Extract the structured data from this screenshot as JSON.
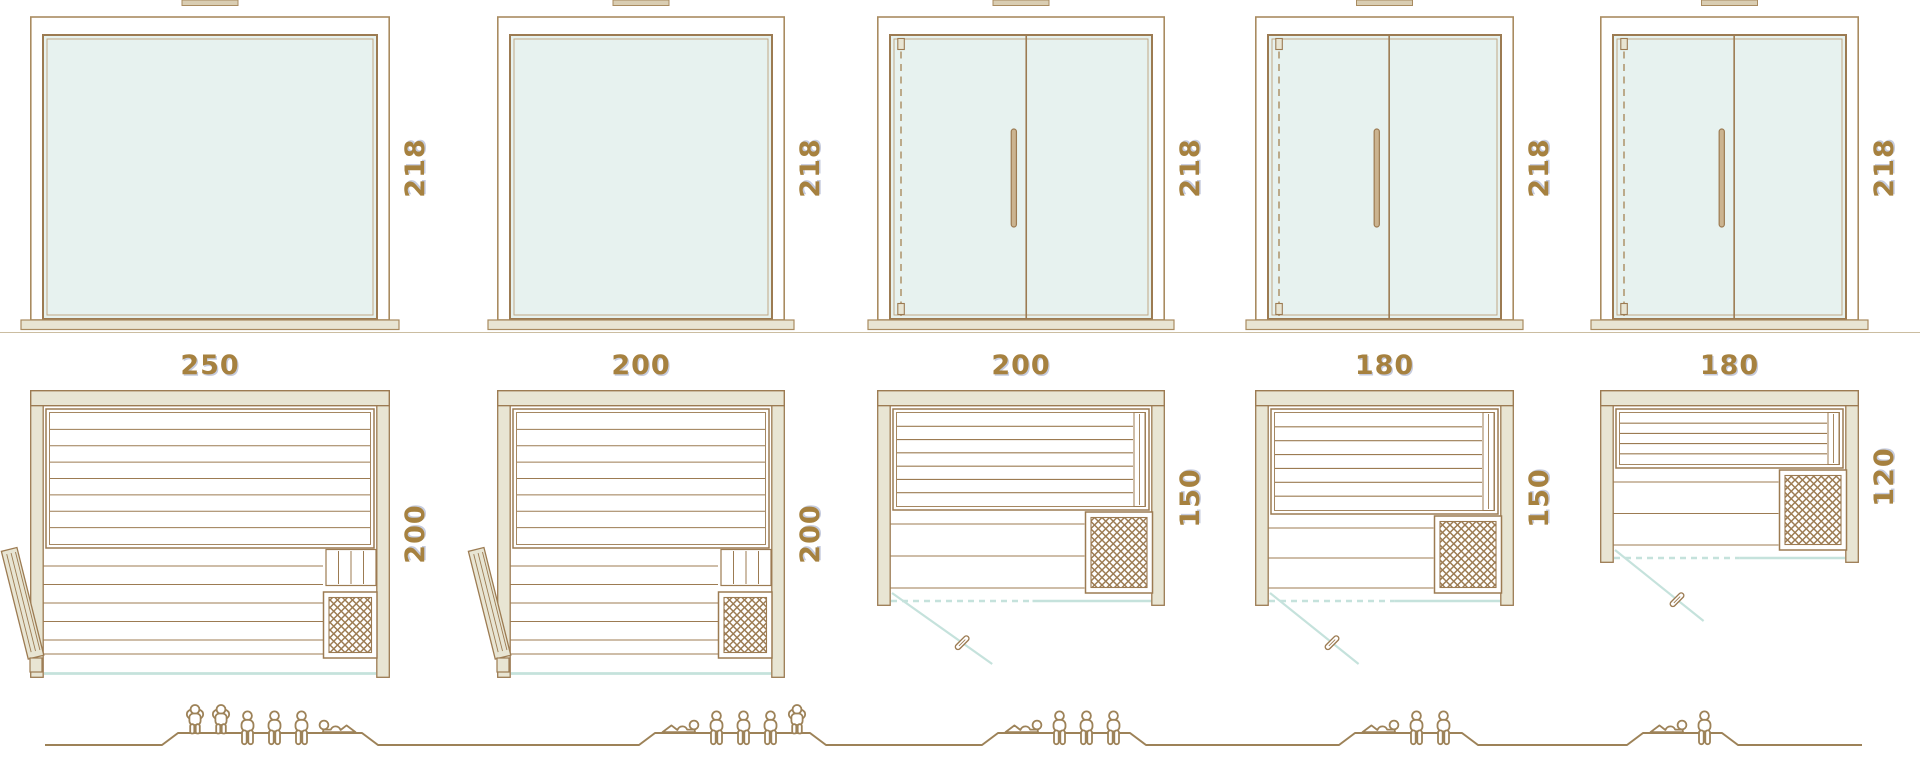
{
  "colors": {
    "outline": "#9c7b52",
    "frame": "#a98b60",
    "outline_light": "#c0a885",
    "label_text": "#a6813f",
    "label_shadow": "rgba(140,152,190,0.5)",
    "glass_fill": "#e7f2ef",
    "wood_fill": "#e8e5d3",
    "wood_dark": "#d9cdb2",
    "handle_fill": "#cbb490",
    "glass_line": "#c5e2dc",
    "floor_line": "#cbbda1",
    "people": "#9d8258",
    "background": "#ffffff"
  },
  "units": [
    {
      "name": "sauna-250x200",
      "front_view": {
        "height_label": "218",
        "glass_double_door": false
      },
      "top_view": {
        "width_label": "250",
        "depth_label": "200",
        "door_style": "wood-side-door"
      },
      "capacity": {
        "pictograms": [
          "standing",
          "standing",
          "sitting",
          "sitting",
          "sitting",
          "lying"
        ],
        "count": 6
      }
    },
    {
      "name": "sauna-200x200",
      "front_view": {
        "height_label": "218",
        "glass_double_door": false
      },
      "top_view": {
        "width_label": "200",
        "depth_label": "200",
        "door_style": "wood-side-door"
      },
      "capacity": {
        "pictograms": [
          "lying",
          "sitting",
          "sitting",
          "sitting",
          "standing"
        ],
        "count": 5
      }
    },
    {
      "name": "sauna-200x150",
      "front_view": {
        "height_label": "218",
        "glass_double_door": true
      },
      "top_view": {
        "width_label": "200",
        "depth_label": "150",
        "door_style": "glass-front-door"
      },
      "capacity": {
        "pictograms": [
          "lying",
          "sitting",
          "sitting",
          "sitting"
        ],
        "count": 4
      }
    },
    {
      "name": "sauna-180x150",
      "front_view": {
        "height_label": "218",
        "glass_double_door": true
      },
      "top_view": {
        "width_label": "180",
        "depth_label": "150",
        "door_style": "glass-front-door"
      },
      "capacity": {
        "pictograms": [
          "lying",
          "sitting",
          "sitting"
        ],
        "count": 3
      }
    },
    {
      "name": "sauna-180x120",
      "front_view": {
        "height_label": "218",
        "glass_double_door": true
      },
      "top_view": {
        "width_label": "180",
        "depth_label": "120",
        "door_style": "glass-front-door"
      },
      "capacity": {
        "pictograms": [
          "lying",
          "sitting"
        ],
        "count": 2
      }
    }
  ]
}
